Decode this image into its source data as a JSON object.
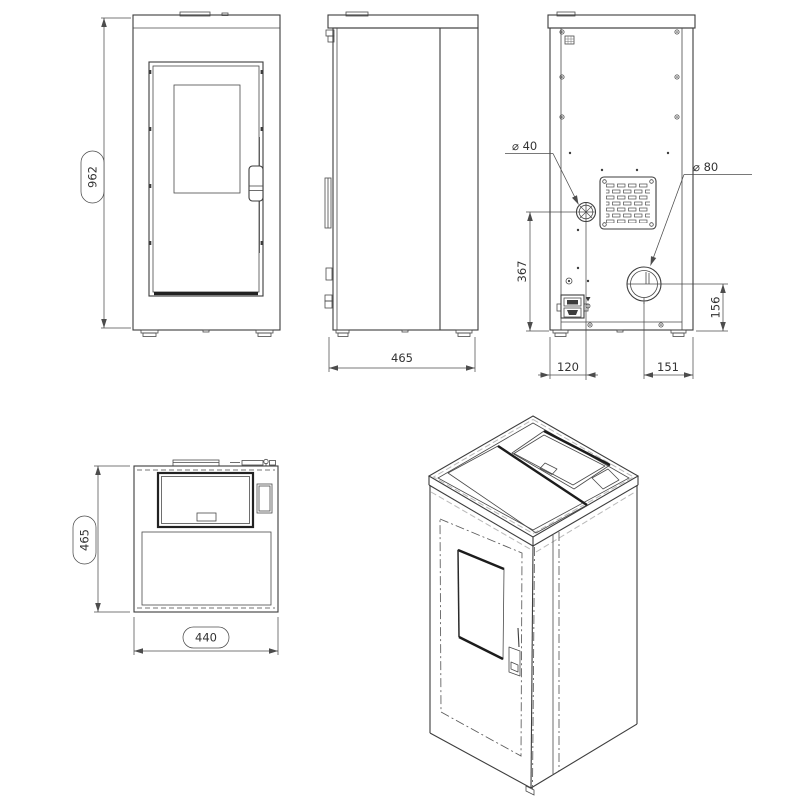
{
  "colors": {
    "line": "#3d3d3d",
    "dimension": "#4c4c4c",
    "phantom_dash": "#b9b9b9",
    "background": "#ffffff"
  },
  "labels": {
    "front_height": "962",
    "side_depth": "465",
    "intake_diameter": "⌀ 40",
    "flue_diameter": "⌀ 80",
    "intake_center_height": "367",
    "flue_center_height": "156",
    "intake_center_offset": "120",
    "flue_center_offset": "151",
    "top_depth": "465",
    "top_width": "440"
  }
}
